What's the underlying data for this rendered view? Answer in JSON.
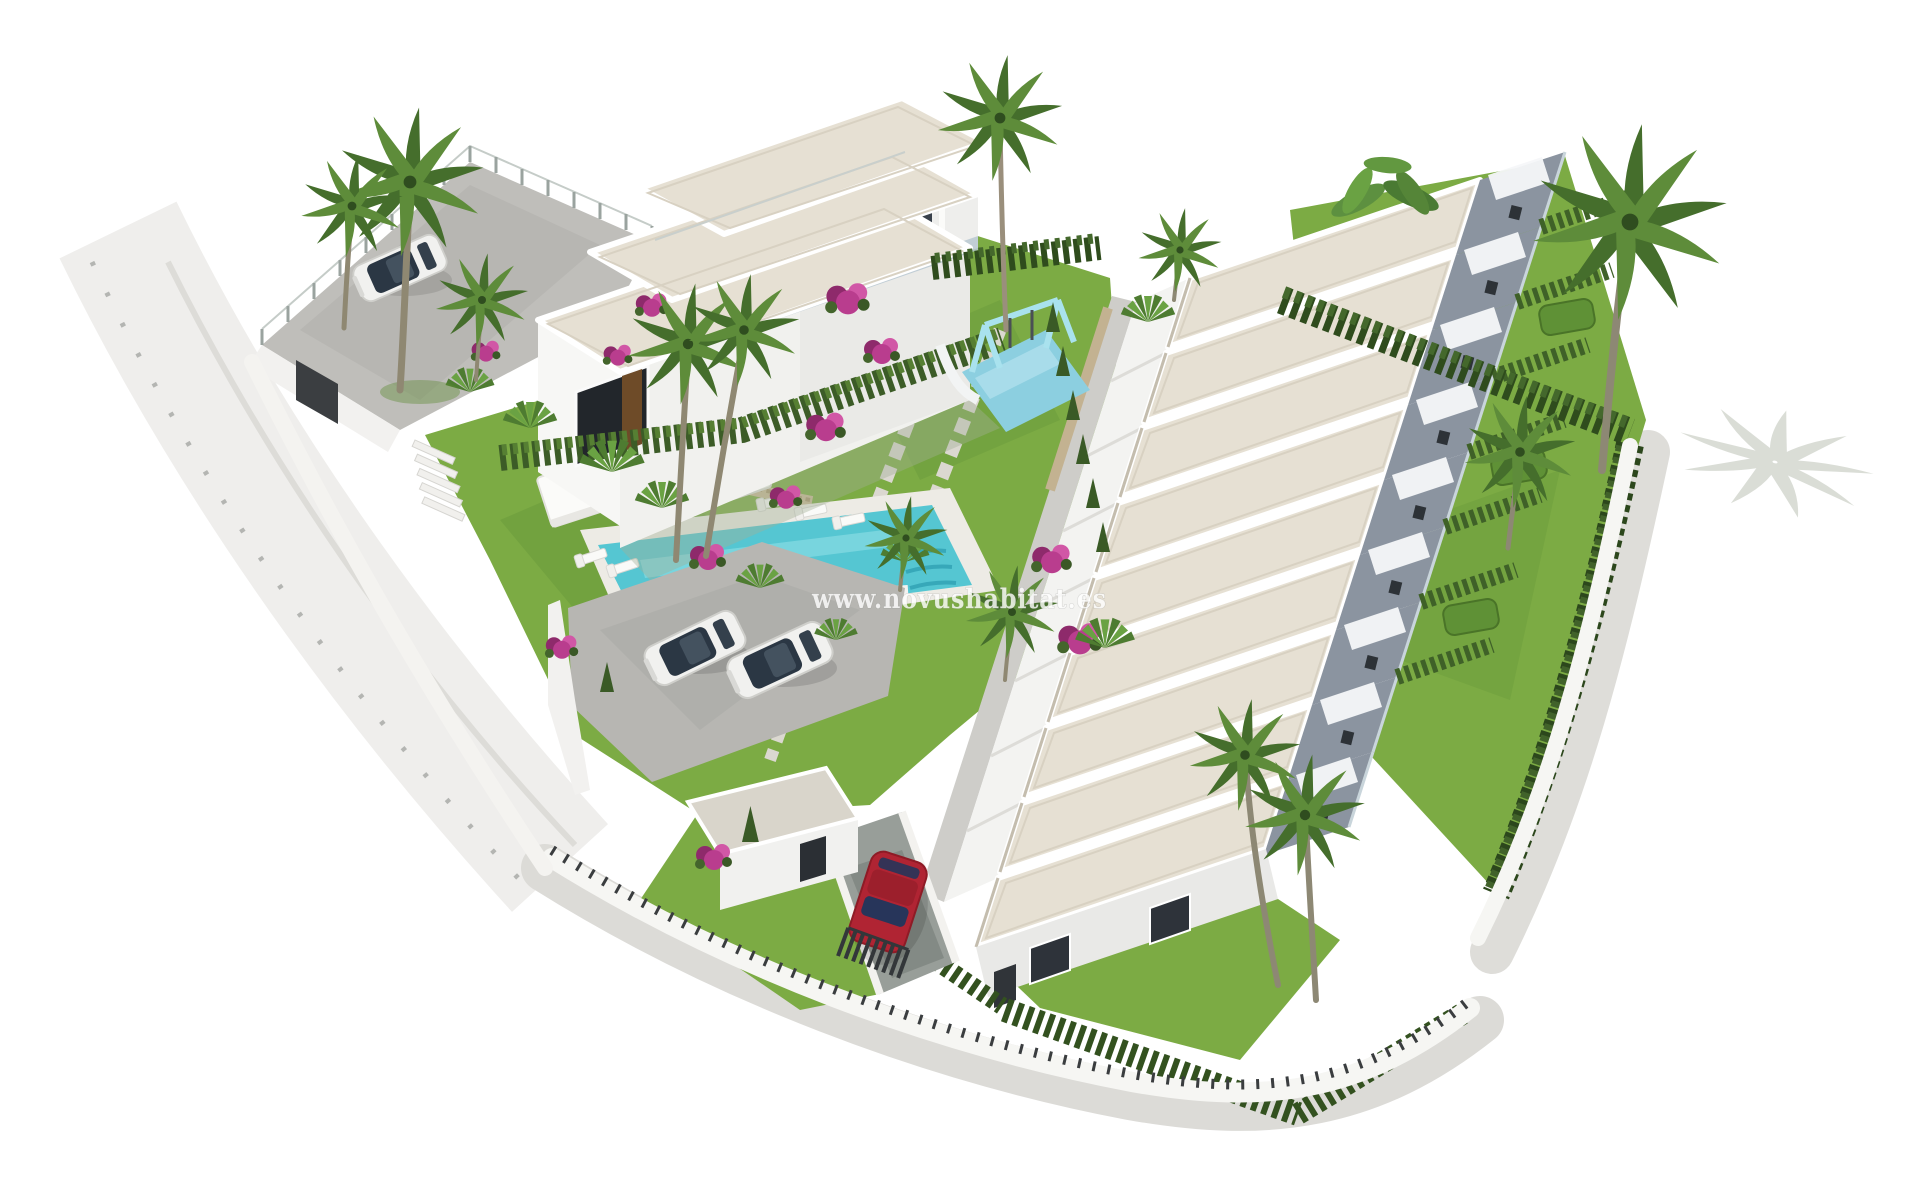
{
  "image": {
    "kind": "aerial-3d-architectural-render",
    "subject": "new-build residential development with villa block, stepped townhouse row, communal garden, pool and parking"
  },
  "watermark": {
    "text": "www.novushabitat.es",
    "color": "#ffffff",
    "outline_color": "#8a8a88",
    "opacity": 0.8
  },
  "scene": {
    "background_color": "#ffffff",
    "villa": {
      "stepped_roof_sections": 3,
      "balcony_recesses": 3,
      "roof_color": "#e6e0d3",
      "wall_color": "#f2f2f0",
      "door_color": "#6e4b28"
    },
    "townhouse_row": {
      "units": 9,
      "roof_color": "#e6e0d3",
      "parapet_color": "#ffffff",
      "side_wall_color": "#f3f3f1",
      "terrace_color": "#8b94a0",
      "awning_color": "#f6f7f9"
    },
    "pool": {
      "water_color": "#55c6d2",
      "deck_color": "#edebe5",
      "has_steps": true,
      "sun_loungers": 5,
      "pergola_color": "#fbfbf9"
    },
    "playground": {
      "mat_color": "#8ccfe0",
      "swing_frame_color": "#a9e2ee",
      "slide_color": "#f2f4f4"
    },
    "vehicles": {
      "white_cars": 3,
      "red_cars": 1,
      "red_car_color": "#b02433",
      "car_glass_color": "#2b3744"
    },
    "landscape": {
      "lawn_color": "#7cab44",
      "cypress_hedge_color": "#2f4c1d",
      "palm_canopy_colors": [
        "#456e2c",
        "#5e8c3a"
      ],
      "bougainvillea_color": "#b93d8e",
      "parking_color": "#b7b6b2",
      "sidewalk_color": "#dcdbd7",
      "boundary_wall_color": "#f6f6f3",
      "gate_color": "#3b3e41",
      "palm_count": 13
    }
  }
}
